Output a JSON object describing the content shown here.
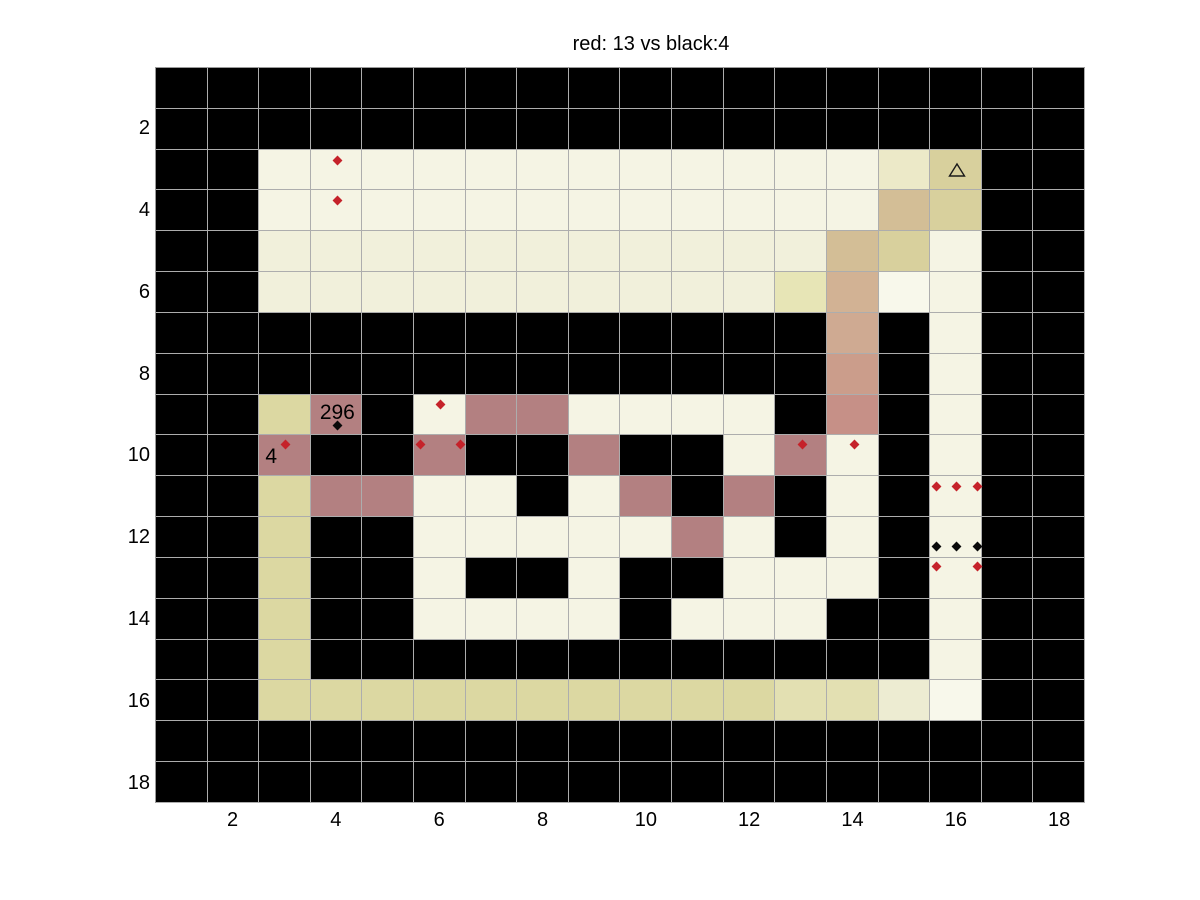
{
  "title": "red: 13 vs black:4",
  "chart_data": {
    "type": "heatmap",
    "title": "red: 13 vs black:4",
    "red_score": 13,
    "black_score": 4,
    "grid_size": {
      "cols": 18,
      "rows": 18
    },
    "x_ticks": [
      2,
      4,
      6,
      8,
      10,
      12,
      14,
      16,
      18
    ],
    "y_ticks": [
      2,
      4,
      6,
      8,
      10,
      12,
      14,
      16,
      18
    ],
    "gridline_color": "#adadad",
    "palette": {
      "K": "#000000",
      "C": "#F5F4E4",
      "c": "#F1F0DB",
      "W": "#F8F8EB",
      "d": "#ECE9C8",
      "D": "#DCD8A2",
      "E": "#E3E0B2",
      "e": "#EDECD2",
      "t": "#D8D09D",
      "T": "#D3BE96",
      "g": "#E7E5B6",
      "1": "#D2B294",
      "2": "#CFAA92",
      "3": "#CB9D8B",
      "4": "#C69087",
      "R": "#B38081"
    },
    "rows": [
      "KKKKKKKKKKKKKKKKKK",
      "KKKKKKKKKKKKKKKKKK",
      "KKCCCCCCCCCCCCdtKK",
      "KKCCCCCCCCCCCCTtKK",
      "KKcccccccccccTtCKK",
      "KKccccccccccg1WCKK",
      "KKKKKKKKKKKKK2KCKK",
      "KKKKKKKKKKKKK3KCKK",
      "KKDRKCRRCCCCK4KCKK",
      "KKRKKRKKRKKCRCKCKK",
      "KKDRRCCKCRKRKCKCKK",
      "KKDKKCCCCCRCKCKCKK",
      "KKDKKCKKCKKCCCKCKK",
      "KKDKKCCCCKCCCKKCKK",
      "KKDKKKKKKKKKKKKCKK",
      "KKDDDDDDDDDDEEeWKK",
      "KKKKKKKKKKKKKKKKKK",
      "KKKKKKKKKKKKKKKKKK"
    ],
    "markers": {
      "red_color": "#C5222A",
      "black_color": "#0A0A0A",
      "red_points": [
        [
          4.01,
          2.76
        ],
        [
          4.01,
          3.75
        ],
        [
          6.01,
          8.72
        ],
        [
          3.01,
          9.72
        ],
        [
          5.61,
          9.72
        ],
        [
          6.4,
          9.72
        ],
        [
          13.01,
          9.72
        ],
        [
          14.01,
          9.72
        ],
        [
          15.6,
          10.74
        ],
        [
          16.0,
          10.74
        ],
        [
          16.4,
          10.74
        ],
        [
          15.6,
          12.69
        ],
        [
          16.4,
          12.69
        ]
      ],
      "black_points": [
        [
          4.02,
          9.24
        ],
        [
          15.6,
          12.21
        ],
        [
          16.0,
          12.21
        ],
        [
          16.4,
          12.21
        ]
      ],
      "triangle": {
        "x": 16.0,
        "y": 3.0
      }
    },
    "cell_labels": [
      {
        "text": "296",
        "x": 4.01,
        "y": 8.94
      },
      {
        "text": "4",
        "x": 2.73,
        "y": 10.01
      }
    ]
  }
}
